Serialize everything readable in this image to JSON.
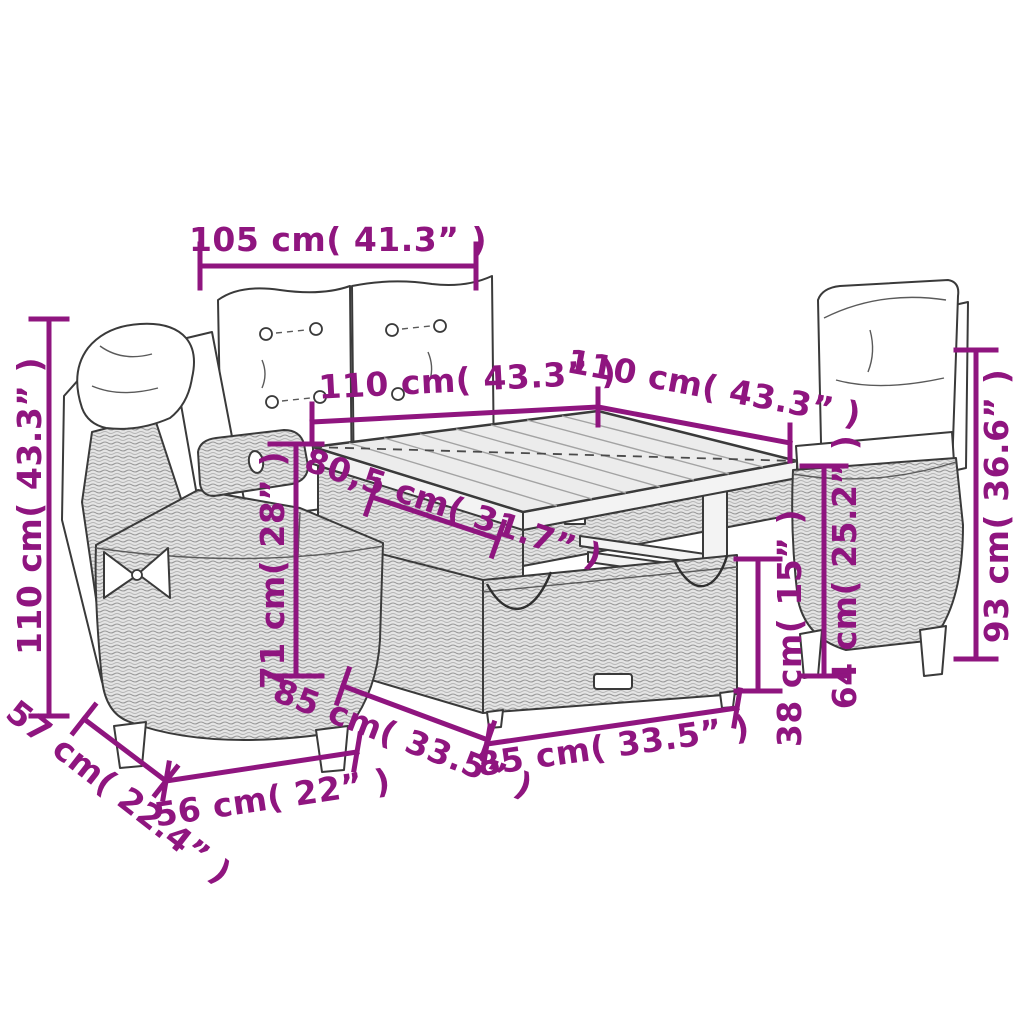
{
  "diagram": {
    "title": "Garden furniture set dimension diagram",
    "accent_color": "#8F157F",
    "line_color": "#3a3a3a",
    "background_color": "#ffffff",
    "parts": [
      "left-reclining-chair",
      "bench-cushions",
      "dining-table-top",
      "storage-base-box",
      "right-reclining-chair"
    ]
  },
  "dimensions": {
    "cushion_width": {
      "label": "105 cm( 41.3” )",
      "cm": 105,
      "in": 41.3
    },
    "table_depth": {
      "label": "110 cm( 43.3” )",
      "cm": 110,
      "in": 43.3
    },
    "table_width": {
      "label": "110 cm( 43.3” )",
      "cm": 110,
      "in": 43.3
    },
    "tabletop_section": {
      "label": "80,5 cm( 31.7” )",
      "cm": 80.5,
      "in": 31.7
    },
    "table_height": {
      "label": "71 cm( 28” )",
      "cm": 71,
      "in": 28
    },
    "left_chair_height": {
      "label": "110 cm( 43.3” )",
      "cm": 110,
      "in": 43.3
    },
    "seat_depth": {
      "label": "57 cm( 22.4” )",
      "cm": 57,
      "in": 22.4
    },
    "seat_width": {
      "label": "56 cm( 22” )",
      "cm": 56,
      "in": 22
    },
    "base_depth": {
      "label": "85 cm( 33.5” )",
      "cm": 85,
      "in": 33.5
    },
    "base_width": {
      "label": "85 cm( 33.5” )",
      "cm": 85,
      "in": 33.5
    },
    "base_height": {
      "label": "38 cm( 15” )",
      "cm": 38,
      "in": 15
    },
    "mid_height": {
      "label": "64 cm( 25.2” )",
      "cm": 64,
      "in": 25.2
    },
    "right_chair_back_height": {
      "label": "93 cm( 36.6” )",
      "cm": 93,
      "in": 36.6
    }
  }
}
